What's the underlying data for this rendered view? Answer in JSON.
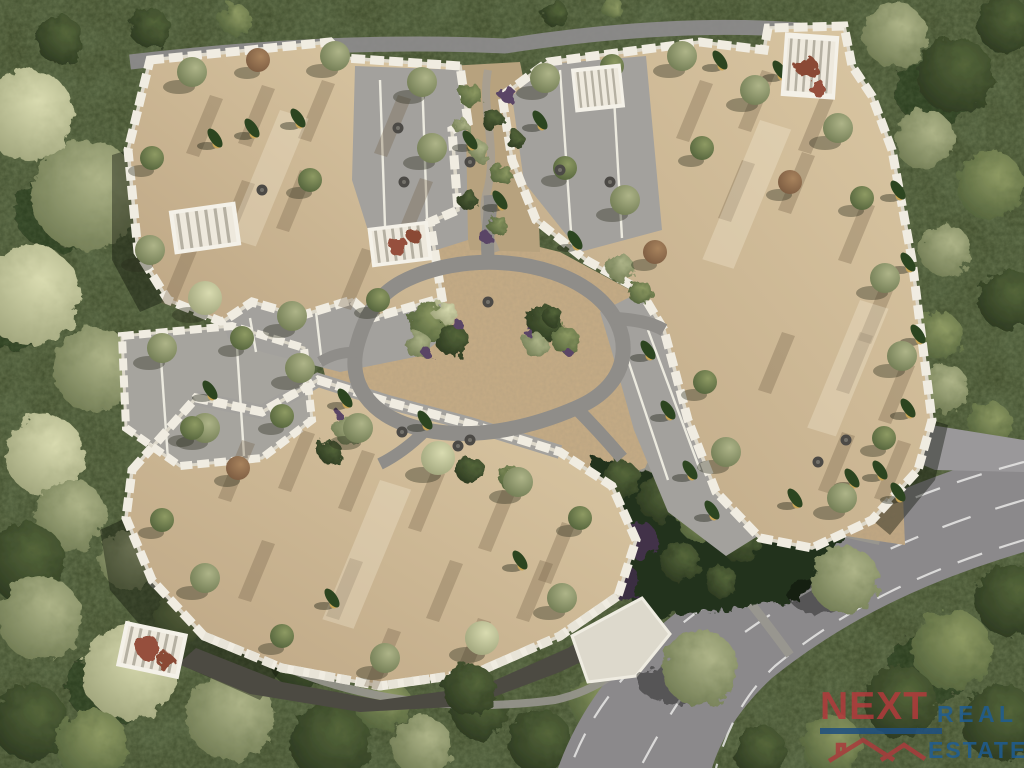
{
  "scene": {
    "label": "Aerial 3D render of a residential complex",
    "setting": "Top-down bird's-eye view of white apartment blocks with beige rooftop terraces arranged around a central landscaped courtyard, surrounded by dense forest, with a curved two-lane road at the bottom right",
    "features": {
      "buildings": "four jagged-edged white apartment blocks with beige roof decks, gray terrace courts, pergolas and rooftop olive and cypress trees",
      "courtyard": "stone-paved plaza with a looping gray walking path, two planted garden islands and small round seating tables",
      "road": "curved asphalt road with white edge and center lane markings sweeping from right edge to bottom",
      "vegetation": "pale olive trees on the left, dark green forest on right and bottom, purple-tinted shrubs along the south facade"
    },
    "palette": {
      "forest_dark": "#2c3a20",
      "grass_green": "#3a4626",
      "tree_pale": "#c3c59b",
      "tree_sage": "#93a073",
      "roof_beige": "#cdb592",
      "wall_white": "#efece1",
      "terrace_gray": "#a3a19d",
      "road_gray": "#8e8c8e",
      "stone_paving": "#c3aa84",
      "lane_marking": "#e9e9e7"
    }
  },
  "watermark": {
    "brand_primary": "NEXT",
    "brand_secondary_top": "REAL",
    "brand_secondary_bottom": "ESTATE",
    "primary_color": "#b23a3c",
    "secondary_color": "#1d5d97"
  }
}
